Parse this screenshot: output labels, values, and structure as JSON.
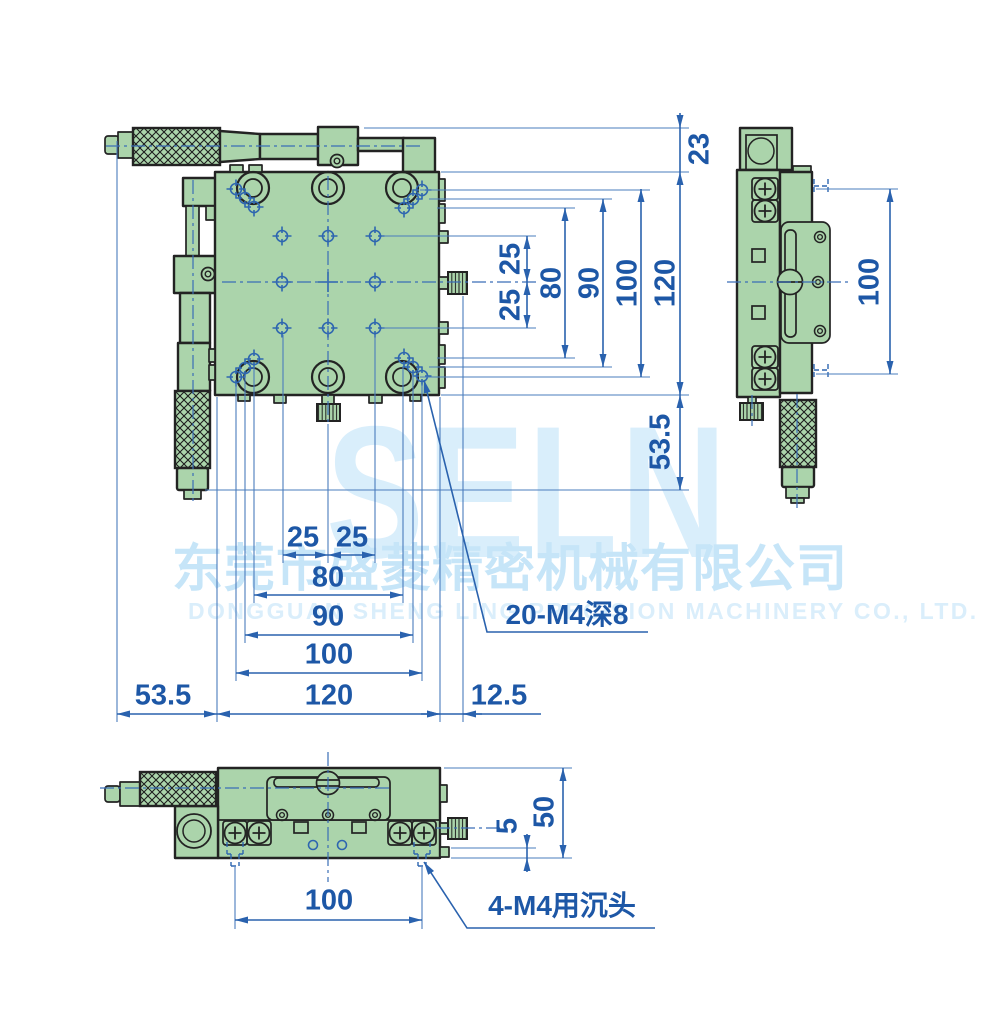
{
  "watermark": {
    "logo": "SELN",
    "company_cn": "东莞市盛菱精密机械有限公司",
    "company_en": "DONGGUAN SHENG LING PRECISION MACHINERY CO., LTD."
  },
  "colors": {
    "body_green": "#abd4ab",
    "outline_dark": "#232323",
    "dimension_blue": "#2a62ae",
    "text_blue": "#1d57a6",
    "watermark_blue": "#d9eefb"
  },
  "dimensions": {
    "front_vertical": {
      "offset_top": "23",
      "pitch_upper": "25",
      "pitch_lower": "25",
      "span_80": "80",
      "span_90": "90",
      "span_100": "100",
      "span_120": "120",
      "micrometer": "53.5"
    },
    "front_horizontal": {
      "pitch_left": "25",
      "pitch_right": "25",
      "span_80": "80",
      "span_90": "90",
      "span_100": "100",
      "span_120": "120",
      "micrometer": "53.5",
      "knob": "12.5"
    },
    "side_view": {
      "span_100": "100"
    },
    "bottom_view": {
      "span_100": "100",
      "step": "5",
      "height": "50"
    },
    "labels": {
      "tapped_holes": "20-M4深8",
      "counterbore": "4-M4用沉头"
    }
  }
}
